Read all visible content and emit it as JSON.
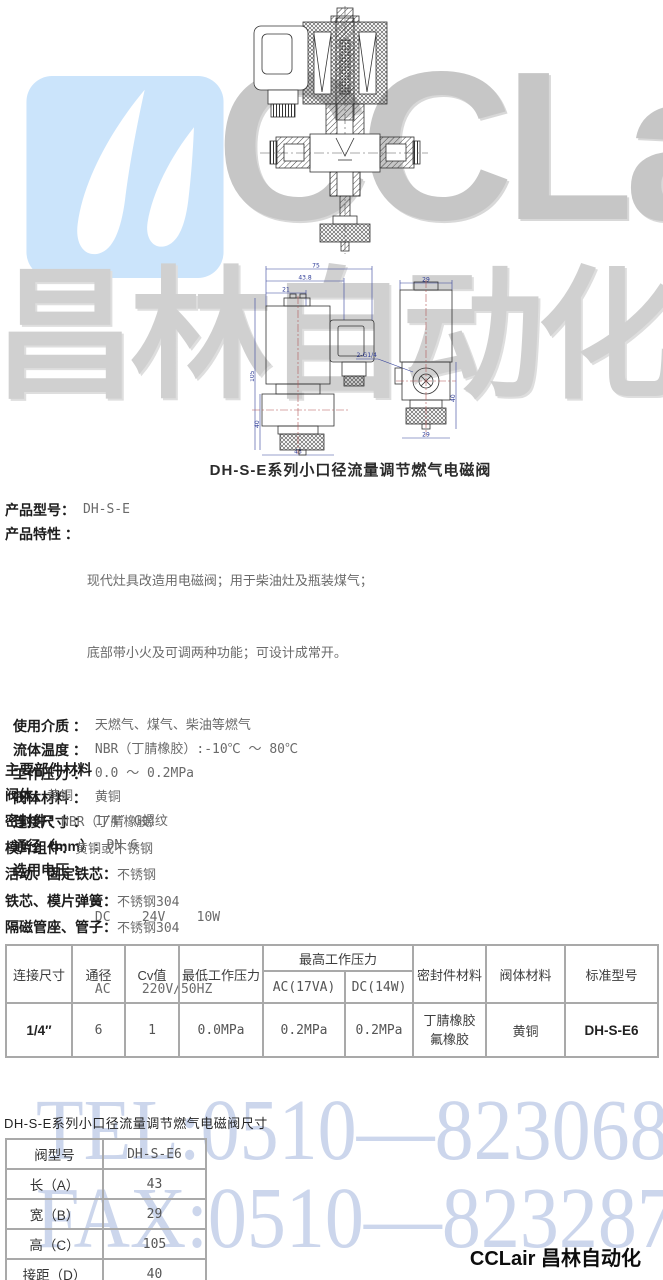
{
  "watermarks": {
    "brand_en": "CCLair",
    "brand_cn": "昌林自动化",
    "tel": "TEL:0510—82306871",
    "fax": "FAX:0510—82328771",
    "logo_bg_color": "#cbe4fb",
    "gray_text_color": "#c6c6c6",
    "blue_text_color": "#ccd6ec"
  },
  "drawing": {
    "caption": "DH-S-E系列小口径流量调节燃气电磁阀",
    "dim_labels": {
      "top1": "75",
      "top2": "43.8",
      "top3": "21",
      "left_height": "105",
      "left_lower": "40",
      "bottom_left": "43",
      "right_top": "29",
      "port": "2-G1/4",
      "right_height": "40",
      "bottom_right": "29"
    }
  },
  "specs": [
    {
      "label": "产品型号：",
      "values": [
        "DH-S-E"
      ]
    },
    {
      "label": "产品特性 ：",
      "values": [
        "现代灶具改造用电磁阀；用于柴油灶及瓶装煤气；",
        "底部带小火及可调两种功能；可设计成常开。"
      ]
    },
    {
      "label": "使用介质 ：",
      "values": [
        "天燃气、煤气、柴油等燃气"
      ]
    },
    {
      "label": "流体温度 ：",
      "values": [
        "NBR（丁腈橡胶）:-10℃ ～ 80℃"
      ]
    },
    {
      "label": "工作压力 ：",
      "values": [
        "0.0 ～ 0.2MPa"
      ]
    },
    {
      "label": "阀体材料 ：",
      "values": [
        "黄铜"
      ]
    },
    {
      "label": "连接尺寸 ：",
      "values": [
        "1/4″ G螺纹"
      ]
    },
    {
      "label": "通径（mm）:",
      "values": [
        "DN 6"
      ]
    },
    {
      "label": "选用电压 ：",
      "values": [
        "DC    24V    10W",
        "AC    220V/50HZ"
      ]
    }
  ],
  "materials": {
    "heading": "主要部件材料",
    "items": [
      {
        "label": "阀体：",
        "value": "黄铜"
      },
      {
        "label": "密封件：",
        "value": "NBR（丁腈橡胶）"
      },
      {
        "label": "模片组件：",
        "value": "黄铜或不锈钢"
      },
      {
        "label": "活动、固定铁芯：",
        "value": "不锈钢"
      },
      {
        "label": "铁芯、模片弹簧：",
        "value": "不锈钢304"
      },
      {
        "label": "隔磁管座、管子：",
        "value": "不锈钢304"
      }
    ]
  },
  "main_table": {
    "headers_row1": [
      "连接尺寸",
      "通径",
      "Cv值",
      "最低工作压力",
      "最高工作压力",
      "密封件材料",
      "阀体材料",
      "标准型号"
    ],
    "headers_row2": [
      "AC(17VA)",
      "DC(14W)"
    ],
    "row": {
      "connection": "1/4″",
      "dn": "6",
      "cv": "1",
      "min_pressure": "0.0MPa",
      "max_pressure_ac": "0.2MPa",
      "max_pressure_dc": "0.2MPa",
      "seal_materials": [
        "丁腈橡胶",
        "氟橡胶"
      ],
      "body_material": "黄铜",
      "model": "DH-S-E6"
    }
  },
  "dimensions": {
    "caption": "DH-S-E系列小口径流量调节燃气电磁阀尺寸",
    "rows": [
      {
        "label": "阀型号",
        "value": "DH-S-E6"
      },
      {
        "label": "长（A）",
        "value": "43"
      },
      {
        "label": "宽（B）",
        "value": "29"
      },
      {
        "label": "高（C）",
        "value": "105"
      },
      {
        "label": "接距（D）",
        "value": "40"
      }
    ]
  },
  "footer": {
    "brand": "CCLair 昌林自动化"
  }
}
